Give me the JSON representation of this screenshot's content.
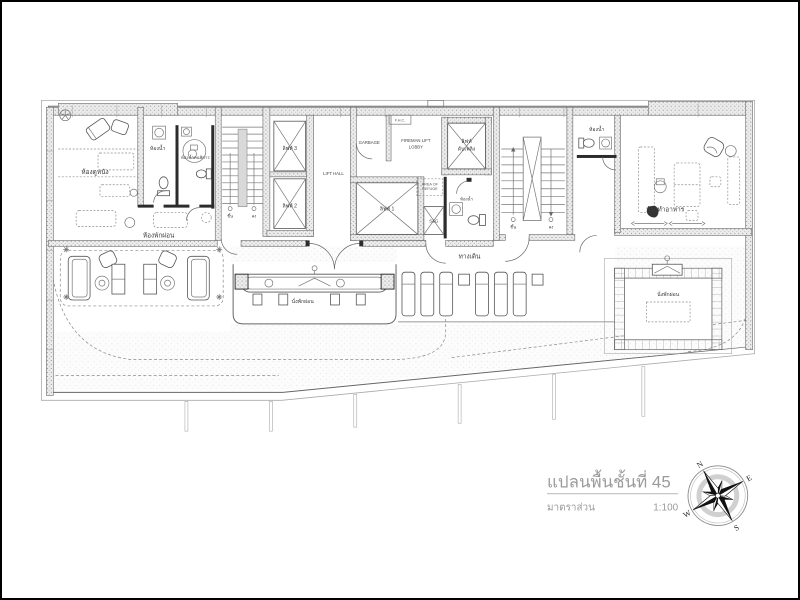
{
  "title_block": {
    "title": "แปลนพื้นชั้นที่ 45",
    "scale_label": "มาตราส่วน",
    "scale_value": "1:100"
  },
  "compass": {
    "n": "N",
    "e": "E",
    "s": "S",
    "w": "W"
  },
  "plan": {
    "movie_room": "ห้องดูหนัง",
    "bathroom": "ห้องน้ำ",
    "bathroom_accessible": "ห้องน้ำคนพิการ",
    "lounge": "ห้องพักผ่อน",
    "kitchen": "ห้องทำอาหาร",
    "corridor": "ทางเดิน",
    "seating": "นั่งพักผ่อน",
    "stair_up": "ขึ้น",
    "stair_down": "ลง",
    "lift_1": "ลิฟท์ 1",
    "lift_2": "ลิฟท์ 2",
    "lift_3": "ลิฟท์ 3",
    "fire_lift_line1": "ลิฟท์",
    "fire_lift_line2": "ดับเพลิง",
    "lift_hall": "LIFT HALL",
    "garbage": "GARBAGE",
    "fhc": "F.H.C.",
    "fireman_lobby_line1": "FIREMAN LIFT",
    "fireman_lobby_line2": "LOBBY",
    "refuge_line1": "AREA OF",
    "refuge_line2": "REFUGE",
    "sg": "S&G"
  },
  "colors": {
    "paper": "#ffffff",
    "border": "#000000",
    "ink": "#3a3a3a",
    "wall_tone": "#9a9a9a",
    "title_gray": "#9b9b9b"
  }
}
